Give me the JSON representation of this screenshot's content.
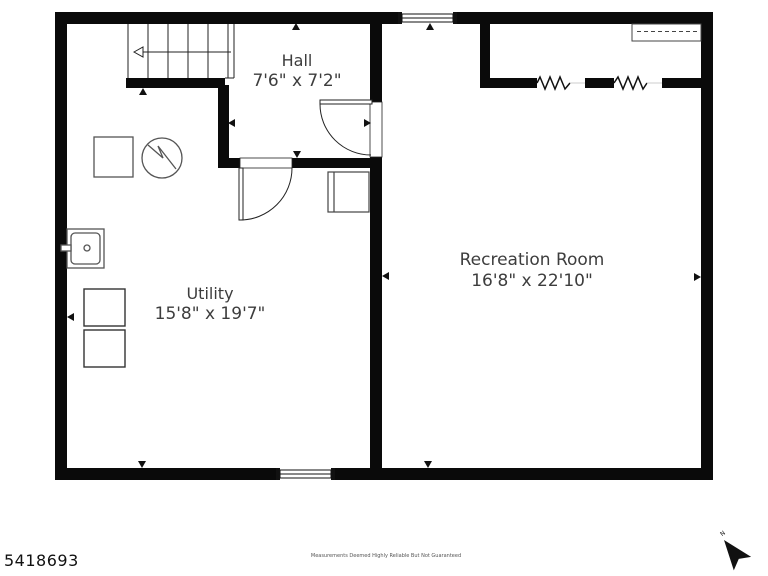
{
  "rooms": [
    {
      "name": "Hall",
      "dims": "7'6\" x 7'2\""
    },
    {
      "name": "Utility",
      "dims": "15'8\" x 19'7\""
    },
    {
      "name": "Recreation Room",
      "dims": "16'8\" x 22'10\""
    }
  ],
  "footer": {
    "listing_id": "5418693",
    "disclaimer": "Measurements Deemed Highly Reliable But Not Guaranteed",
    "compass_label": "N"
  },
  "symbols": [
    "staircase-icon",
    "stair-direction-arrow-icon",
    "water-heater-icon",
    "furnace-icon",
    "sink-icon",
    "washer-icon",
    "dryer-icon",
    "appliance-icon",
    "closet-rod-icon",
    "window-icon",
    "door-swing-icon",
    "wall-break-icon",
    "wall-tick-icon",
    "compass-north-icon"
  ],
  "colors": {
    "wall": "#0a0a0a",
    "fixture_stroke": "#555555",
    "label_text": "#3d3d3d",
    "background": "#ffffff"
  }
}
